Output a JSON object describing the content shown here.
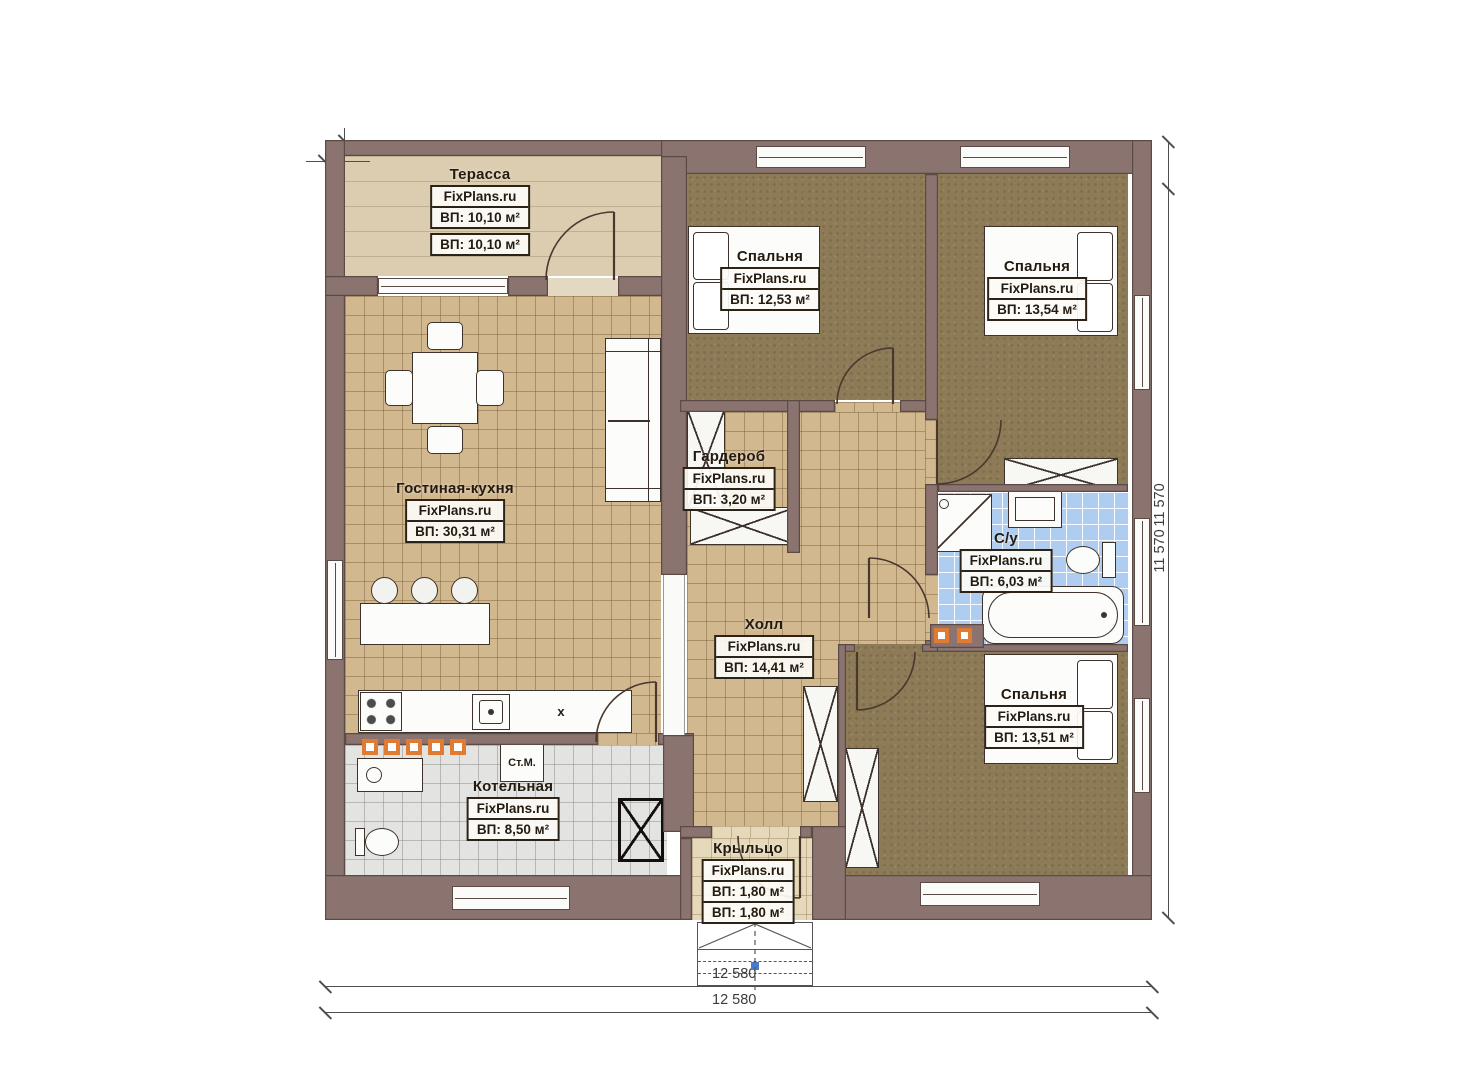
{
  "plan": {
    "brand": "FixPlans.ru",
    "rooms": [
      {
        "id": "terrace",
        "title": "Терасса",
        "area": "ВП: 10,10 м²"
      },
      {
        "id": "bedroom-1",
        "title": "Спальня",
        "area": "ВП: 12,53 м²"
      },
      {
        "id": "bedroom-2",
        "title": "Спальня",
        "area": "ВП: 13,54 м²"
      },
      {
        "id": "living-kitchen",
        "title": "Гостиная-кухня",
        "area": "ВП: 30,31 м²"
      },
      {
        "id": "wardrobe",
        "title": "Гардероб",
        "area": "ВП: 3,20 м²"
      },
      {
        "id": "hall",
        "title": "Холл",
        "area": "ВП: 14,41 м²"
      },
      {
        "id": "bathroom",
        "title": "С/у",
        "area": "ВП: 6,03 м²"
      },
      {
        "id": "bedroom-3",
        "title": "Спальня",
        "area": "ВП: 13,51 м²"
      },
      {
        "id": "boiler",
        "title": "Котельная",
        "area": "ВП: 8,50 м²"
      },
      {
        "id": "porch",
        "title": "Крыльцо",
        "area": "ВП: 1,80 м²"
      }
    ],
    "annotations": {
      "washing_machine": "Ст.М.",
      "kitchen_marker": "x"
    },
    "dimensions": {
      "overall_width": "12 580",
      "overall_height": "11 570"
    },
    "colors": {
      "wall": "#8b7470",
      "floor_tile": "#d2b88f",
      "floor_carpet": "#8d7a56",
      "floor_bath": "#aecdf0",
      "floor_boiler": "#e3e3e1",
      "floor_terrace": "#dccdb0",
      "accent_orange": "#e07b33"
    }
  }
}
